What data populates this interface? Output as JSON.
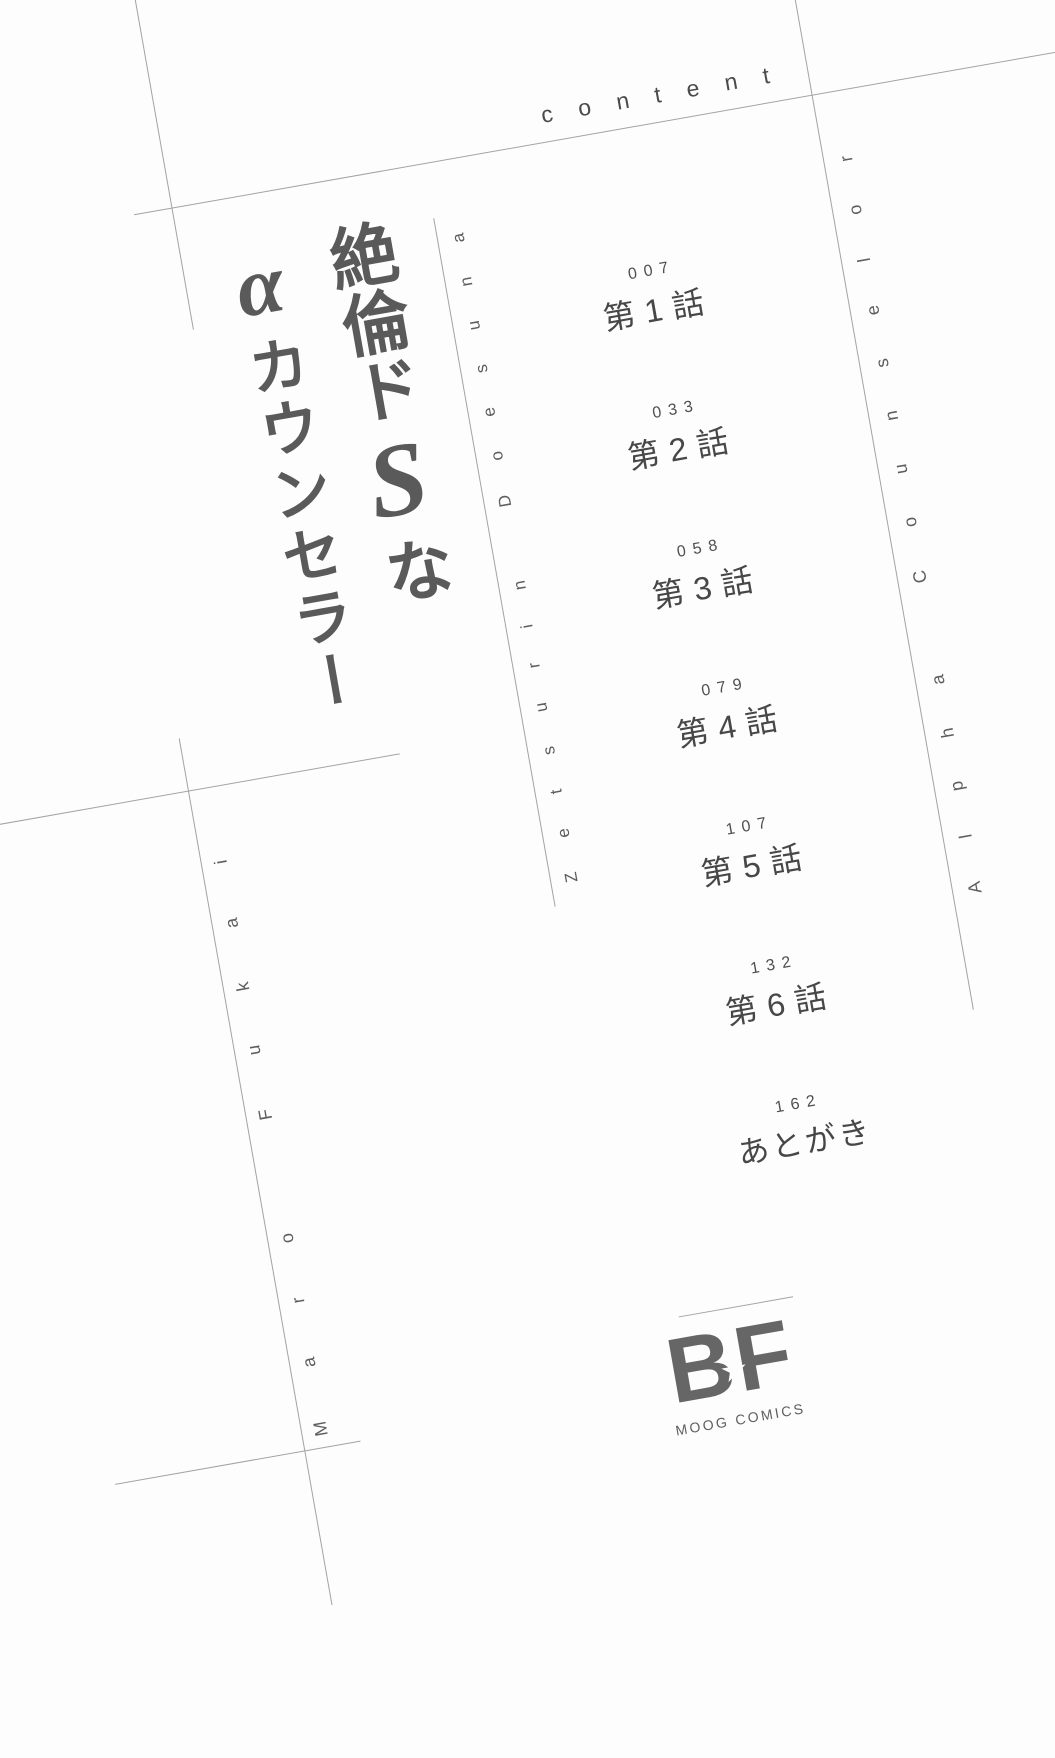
{
  "page": {
    "content_label": "content",
    "title": {
      "part1": "絶倫ド",
      "part2": "S",
      "part3": "な",
      "part4": "α",
      "part5": "カウンセラー",
      "romaji_title": "Zetsurin Doesuna",
      "romaji_subtitle": "Alpha Counselor",
      "author_romaji": "Maro Fukai"
    },
    "toc": [
      {
        "page": "007",
        "label": "第1話"
      },
      {
        "page": "033",
        "label": "第2話"
      },
      {
        "page": "058",
        "label": "第3話"
      },
      {
        "page": "079",
        "label": "第4話"
      },
      {
        "page": "107",
        "label": "第5話"
      },
      {
        "page": "132",
        "label": "第6話"
      },
      {
        "page": "162",
        "label": "あとがき"
      }
    ],
    "logo": {
      "b": "B",
      "f": "F",
      "star": "★",
      "subtext": "MOOG COMICS"
    },
    "colors": {
      "background": "#fdfdfd",
      "rule_gray": "#a3a3a3",
      "title_gray": "#5a5a5a",
      "text_gray": "#4a4a4a",
      "logo_gray": "#666666"
    }
  }
}
